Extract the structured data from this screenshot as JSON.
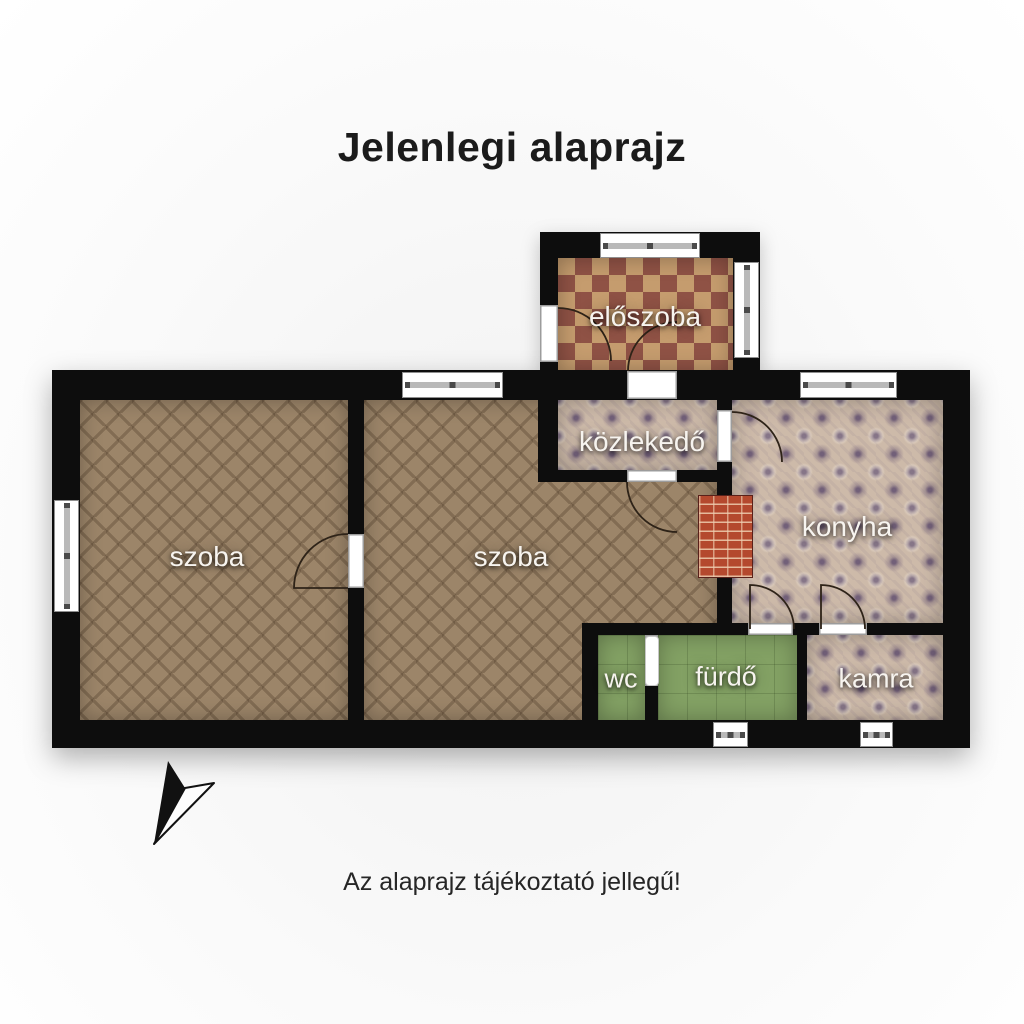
{
  "page": {
    "title": "Jelenlegi alaprajz",
    "disclaimer": "Az alaprajz tájékoztató jellegű!"
  },
  "rooms": {
    "eloszoba": {
      "label": "előszoba"
    },
    "kozlekedo": {
      "label": "közlekedő"
    },
    "konyha": {
      "label": "konyha"
    },
    "szoba1": {
      "label": "szoba"
    },
    "szoba2": {
      "label": "szoba"
    },
    "wc": {
      "label": "wc"
    },
    "furdo": {
      "label": "fürdő"
    },
    "kamra": {
      "label": "kamra"
    }
  },
  "icons": {
    "north_arrow": "north-arrow"
  },
  "colors": {
    "wall": "#0d0d0d",
    "wood_floor": "#9c8569",
    "checker_dark": "#8f5245",
    "checker_light": "#c59c6e",
    "ornate_tile_base": "#cdbaa9",
    "ornate_tile_accent": "#6e5c76",
    "green_tile": "#83a164",
    "brick_stove": "#b4492e",
    "window_frame": "#8f8f8f"
  }
}
